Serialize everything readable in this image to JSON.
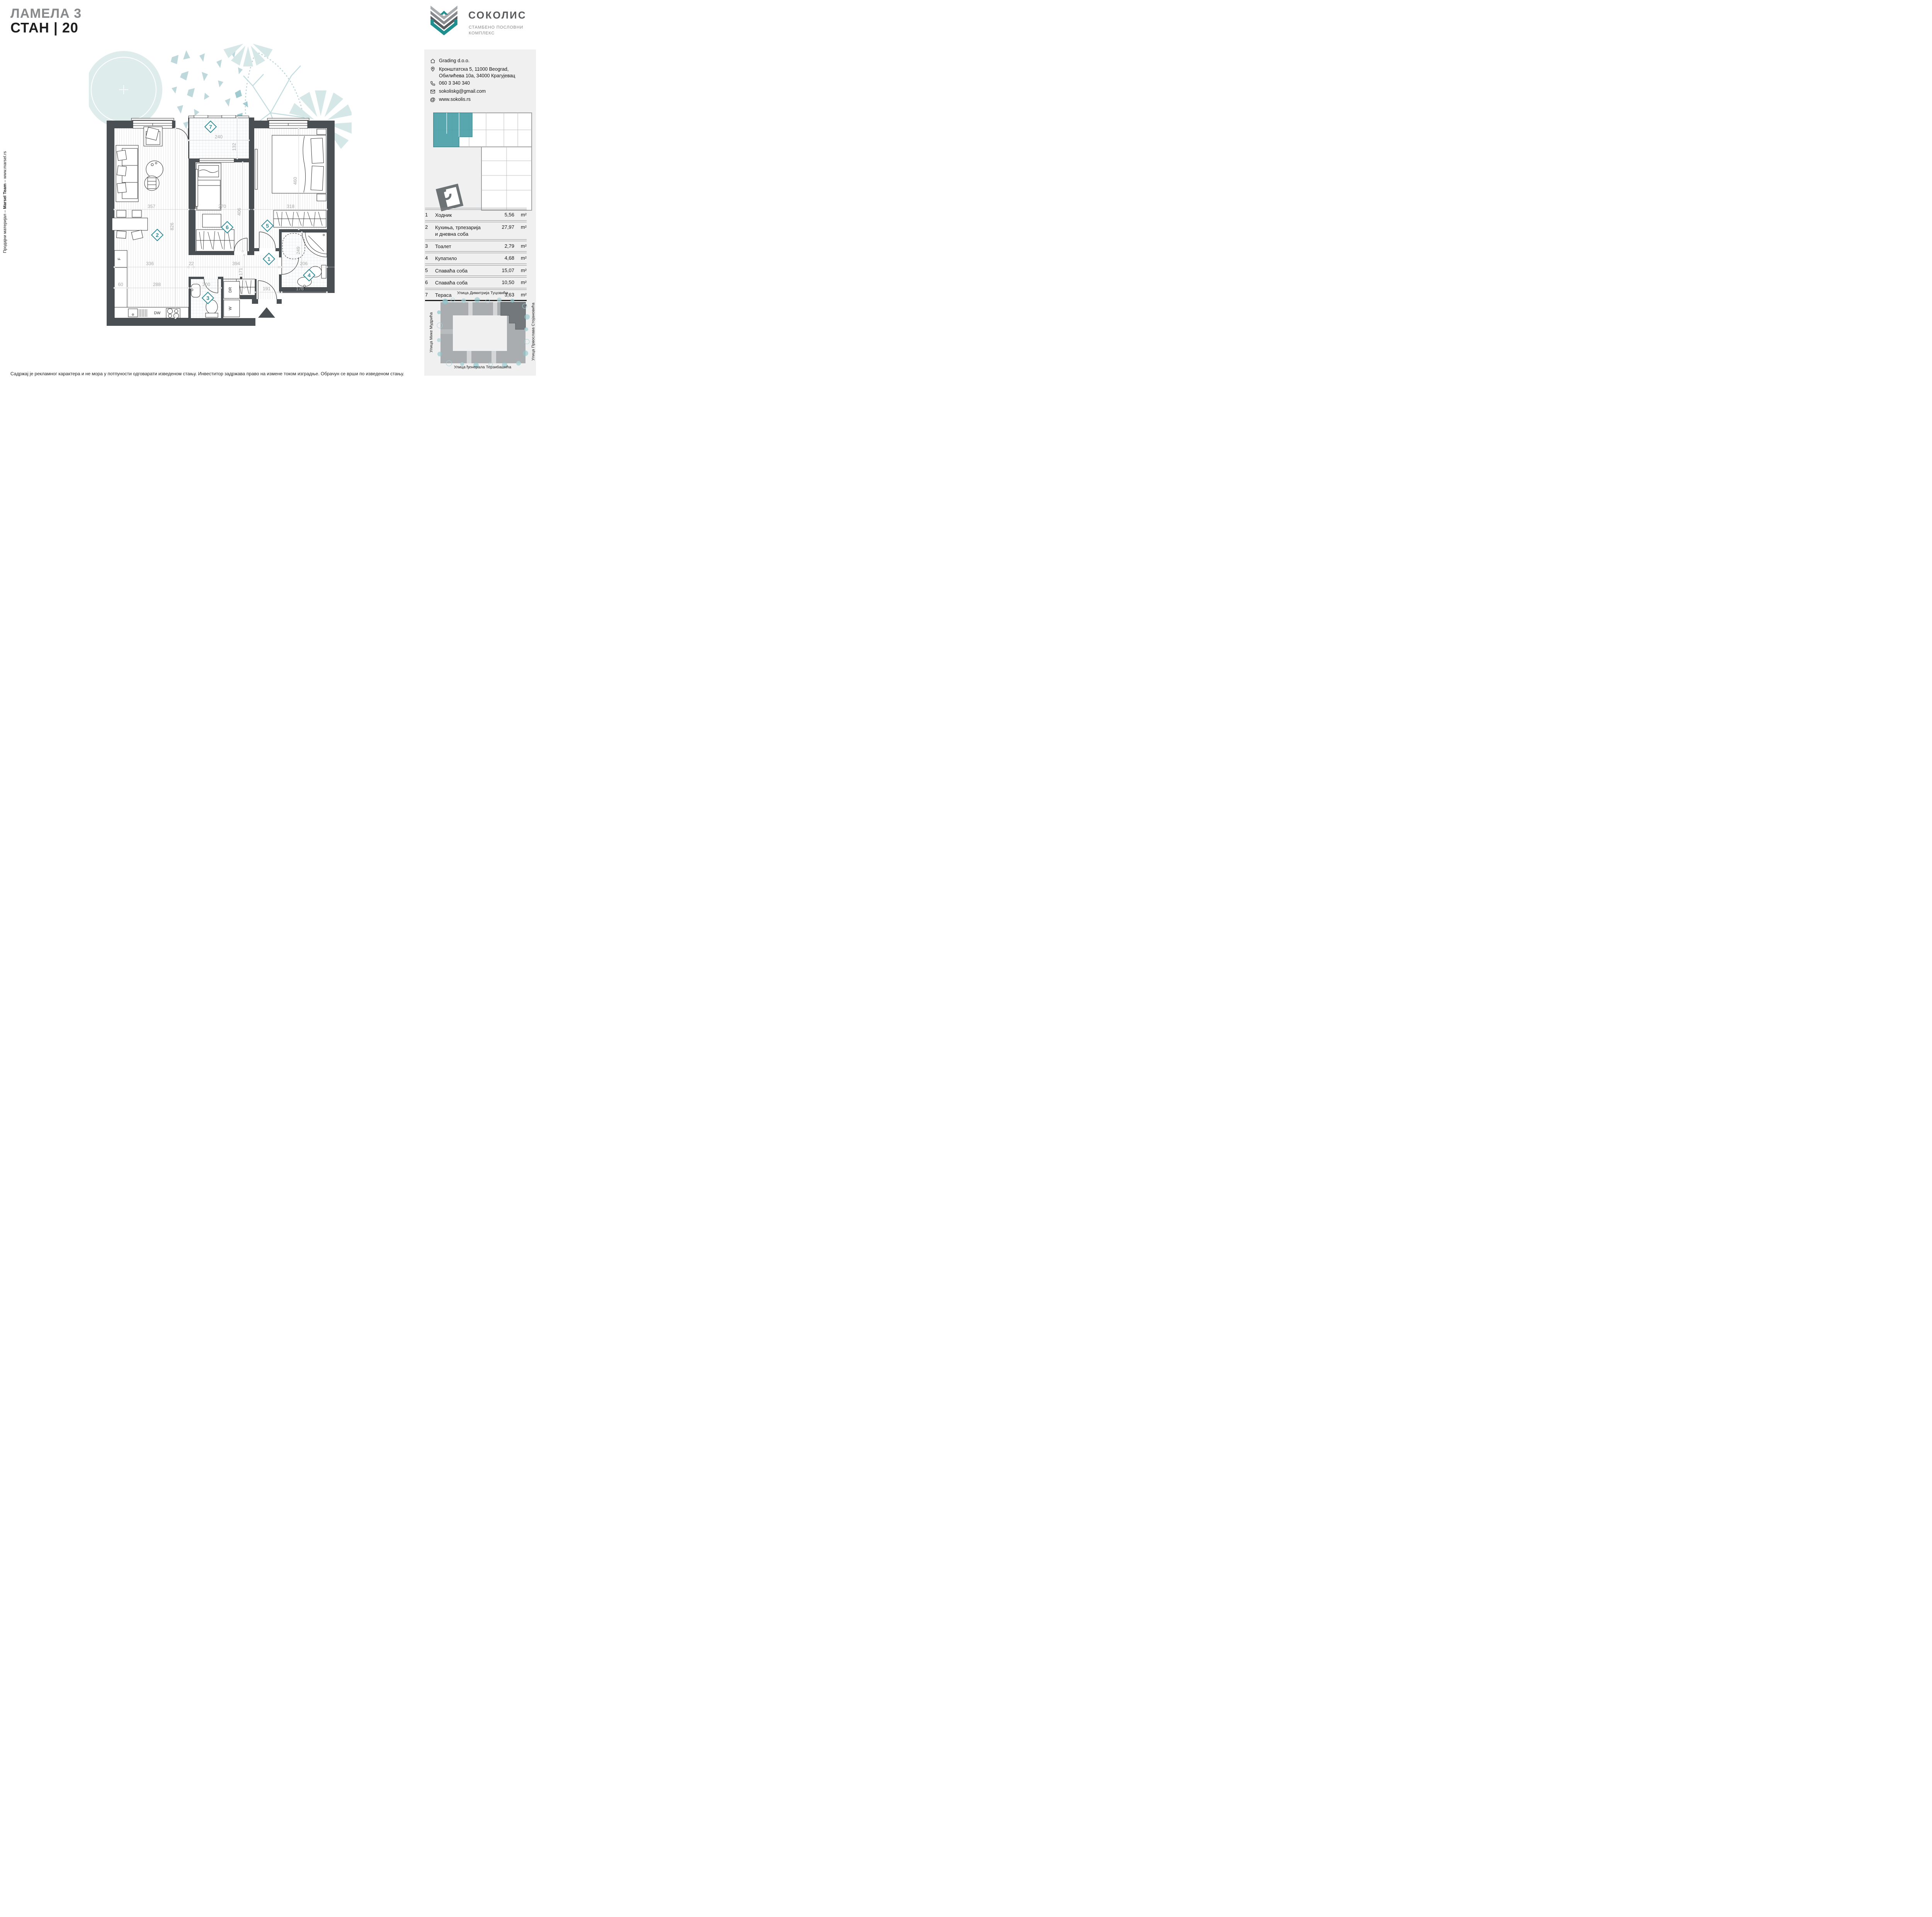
{
  "page": {
    "title_line1": "ЛАМЕЛА 3",
    "title_line2": "СТАН | 20"
  },
  "side_note": {
    "prefix": "Продајни материјал – ",
    "bold": "Marsel Team",
    "suffix": " – www.marsel.rs"
  },
  "disclaimer": "Садржај је рекламног карактера и не мора у потпуности одговарати изведеном стању. Инвеститор задржава право на измене током изградње. Обрачун се врши по изведеном стању.",
  "logo": {
    "name": "СОКОЛИС",
    "subtitle1": "СТАМБЕНО ПОСЛОВНИ",
    "subtitle2": "КОМПЛЕКС"
  },
  "contact": {
    "company": "Grading d.o.o.",
    "address1": "Кронштатска 5, 11000 Beograd,",
    "address2": "Обилићева 10а, 34000 Крагујевац",
    "phone": "060 3 340 340",
    "email": "sokoliskg@gmail.com",
    "website": "www.sokolis.rs",
    "at_glyph": "@"
  },
  "rooms": {
    "rows": [
      {
        "num": "1",
        "name": "Ходник",
        "name2": "",
        "area": "5,56",
        "unit": "m²"
      },
      {
        "num": "2",
        "name": "Кухиња, трпезарија",
        "name2": "и дневна соба",
        "area": "27,97",
        "unit": "m²"
      },
      {
        "num": "3",
        "name": "Тоалет",
        "name2": "",
        "area": "2,79",
        "unit": "m²"
      },
      {
        "num": "4",
        "name": "Купатило",
        "name2": "",
        "area": "4,68",
        "unit": "m²"
      },
      {
        "num": "5",
        "name": "Спаваћа соба",
        "name2": "",
        "area": "15,07",
        "unit": "m²"
      },
      {
        "num": "6",
        "name": "Спаваћа соба",
        "name2": "",
        "area": "10,50",
        "unit": "m²"
      },
      {
        "num": "7",
        "name": "Тераса",
        "name2": "",
        "area": "3,63",
        "unit": "m²"
      }
    ],
    "total_label": "Укупно:",
    "total_area": "70,20",
    "total_unit": "m²"
  },
  "site_plan": {
    "street_top": "Улица Димитрија Туцовића",
    "street_left": "Улица Мике Мудрића",
    "street_right": "Улица Првослава Стојановића",
    "street_bottom": "Улица ђенерала Терзибашића"
  },
  "floor_plan": {
    "numbers": {
      "hall": "1",
      "living": "2",
      "toilet": "3",
      "bathroom": "4",
      "bedroom1": "5",
      "bedroom2": "6",
      "terrace": "7"
    },
    "dims": {
      "living_w": "357",
      "bedroom2_w": "270",
      "bedroom1_w": "318",
      "terrace_w": "240",
      "terrace_h": "132",
      "living_h": "826",
      "bedroom2_h": "406",
      "bedroom1_h": "460",
      "kitchen_w": "336",
      "wall": "22",
      "hall_w": "394",
      "hall_h": "171",
      "entry_w": "191",
      "bath_w": "206",
      "sink_w": "176",
      "shower_h": "249",
      "counter_d": "60",
      "counter_w": "288",
      "toilet_w": "200"
    },
    "labels": {
      "dishwasher": "DW",
      "fridge": "F",
      "dryer": "DR",
      "washer": "W"
    }
  },
  "colors": {
    "accent_teal": "#2e8b96",
    "wall": "#4a4f54",
    "logo_teal": "#1e8e8e",
    "panel_bg": "#f0f0f1",
    "dim_text": "#a6a6a6",
    "title_gray": "#87898b",
    "watercolor": "#cfe3e5",
    "site_building": "#a9adb0",
    "site_highlight": "#73787c",
    "keyplan_highlight": "#4aa0a8"
  }
}
